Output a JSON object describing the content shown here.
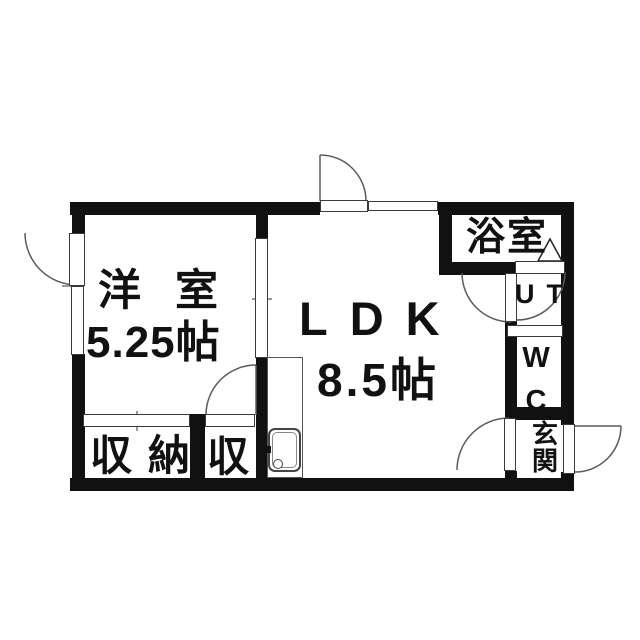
{
  "plan_type": "apartment-floor-plan",
  "rooms": {
    "western": {
      "name": "洋室",
      "size": "5.25帖"
    },
    "ldk": {
      "name": "LDK",
      "size": "8.5帖"
    },
    "bath": {
      "name": "浴室"
    },
    "utility": {
      "name": "UT"
    },
    "toilet": {
      "name": "WC"
    },
    "entrance": {
      "name": "玄関"
    },
    "closet": {
      "name": "収納"
    },
    "sub_closet": {
      "name": "収"
    }
  },
  "colors": {
    "wall": "#111111",
    "text": "#111111",
    "swing_line": "#5a5a5a",
    "background": "#ffffff"
  }
}
